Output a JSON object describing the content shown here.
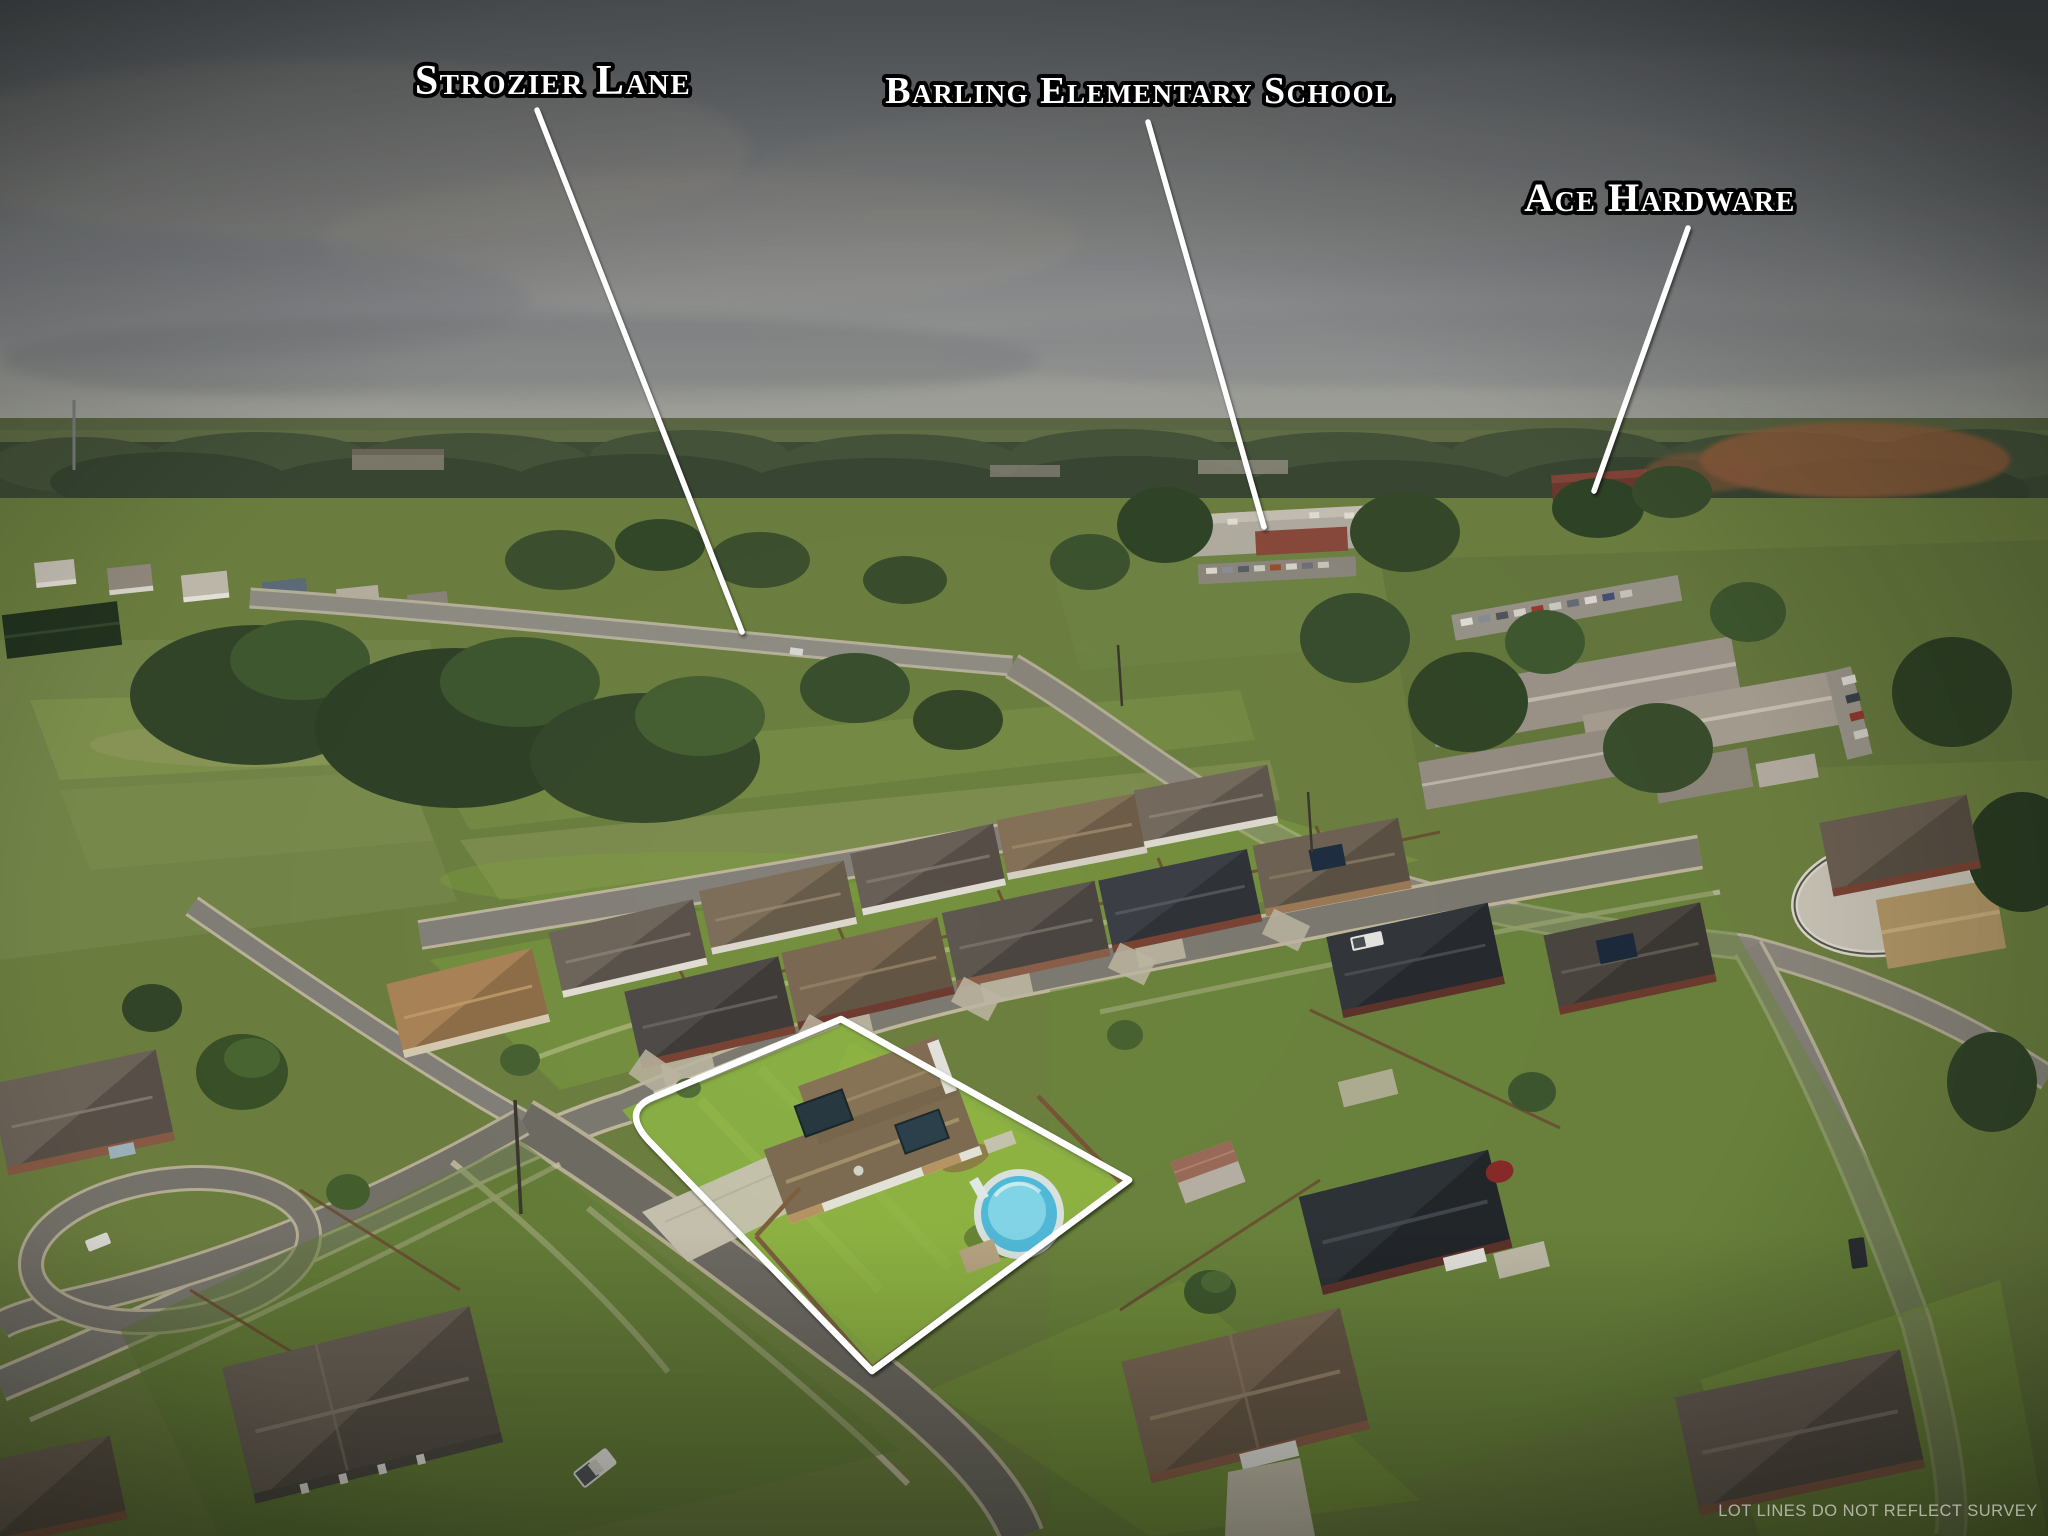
{
  "photo": {
    "description": "Aerial drone photograph of a suburban neighborhood with the subject property outlined in white",
    "annotations": [
      {
        "id": "strozier-lane",
        "text": "Strozier Lane"
      },
      {
        "id": "barling-elementary-school",
        "text": "Barling Elementary School"
      },
      {
        "id": "ace-hardware",
        "text": "Ace Hardware"
      }
    ],
    "disclaimer": "LOT LINES DO NOT REFLECT SURVEY",
    "colors": {
      "label_text": "#ffffff",
      "label_outline": "#000000",
      "pointer_line": "#ffffff",
      "lot_outline": "#ffffff",
      "pool_water": "#55c3e8",
      "sky": "#8a8d90",
      "grass": "#6f8f3c",
      "subject_lawn": "#8cb13e",
      "road": "#7d7a72",
      "roof_brown": "#7d6a56"
    }
  }
}
